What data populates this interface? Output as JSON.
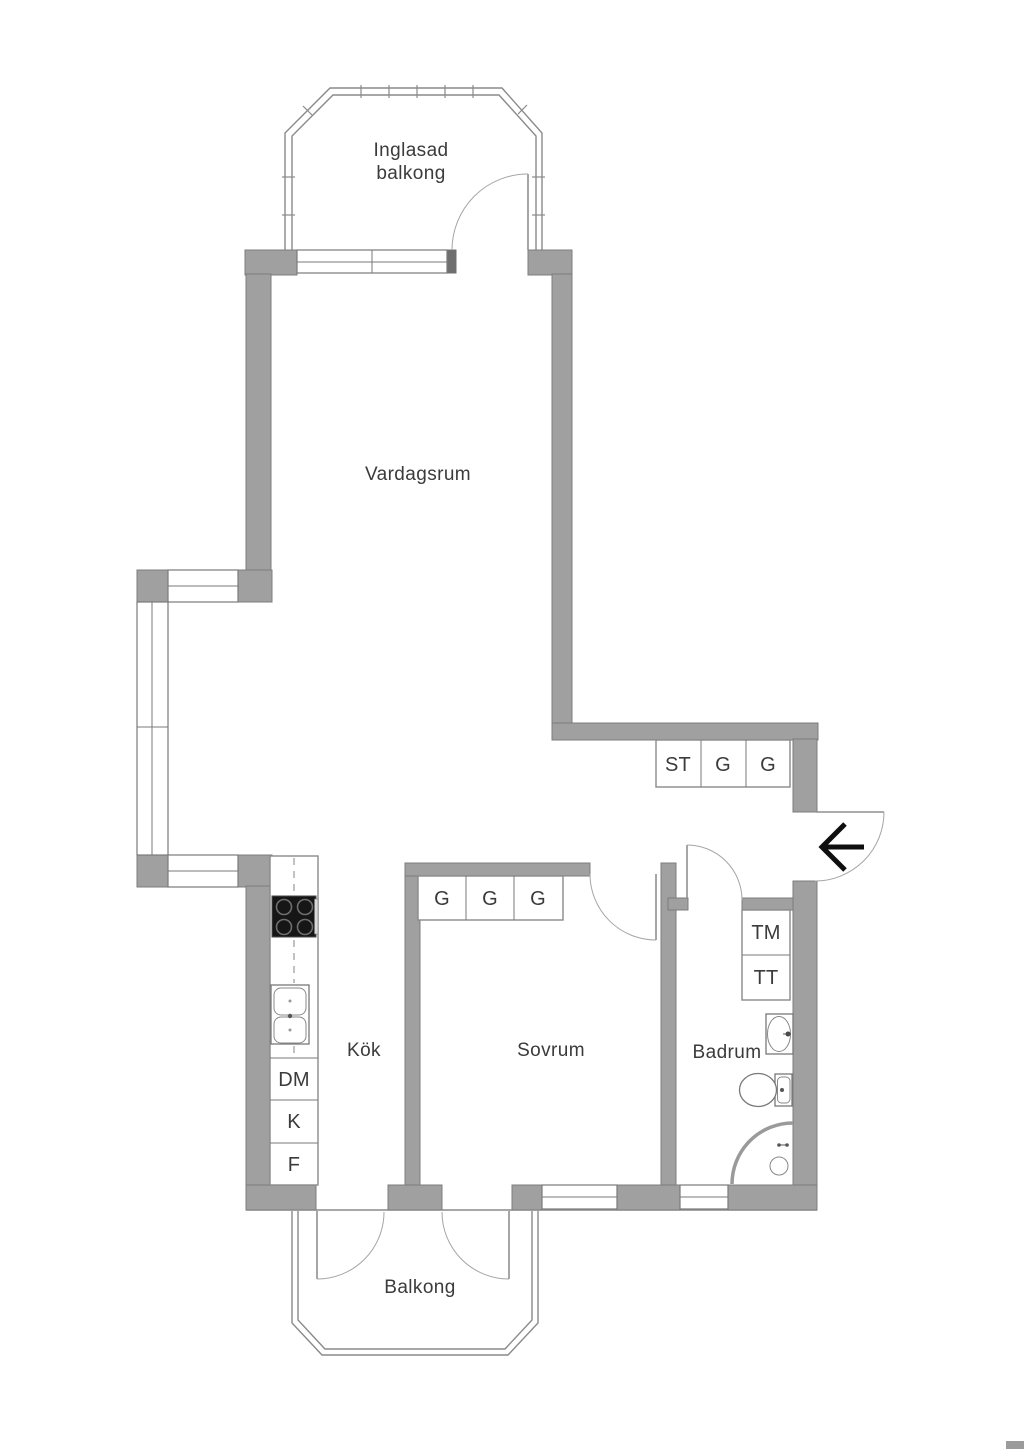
{
  "plan_title": "Apartment floor plan",
  "colors": {
    "wall": "#a0a0a0",
    "wall_outline": "#7d7d7d",
    "window_line": "#7a7a7a",
    "door_arc": "#a5a5a5",
    "text": "#3b3b3b",
    "appliance_black": "#161616",
    "background": "#ffffff"
  },
  "rooms": {
    "glazed_balcony": {
      "line1": "Inglasad",
      "line2": "balkong"
    },
    "living_room": {
      "label": "Vardagsrum"
    },
    "kitchen": {
      "label": "Kök"
    },
    "bedroom": {
      "label": "Sovrum"
    },
    "bathroom": {
      "label": "Badrum"
    },
    "balcony": {
      "label": "Balkong"
    }
  },
  "closets": {
    "hall": [
      "ST",
      "G",
      "G"
    ],
    "bedroom": [
      "G",
      "G",
      "G"
    ],
    "bathroom": [
      "TM",
      "TT"
    ],
    "kitchen": [
      "DM",
      "K",
      "F"
    ]
  },
  "icons": {
    "entrance_arrow": "arrow-left"
  }
}
